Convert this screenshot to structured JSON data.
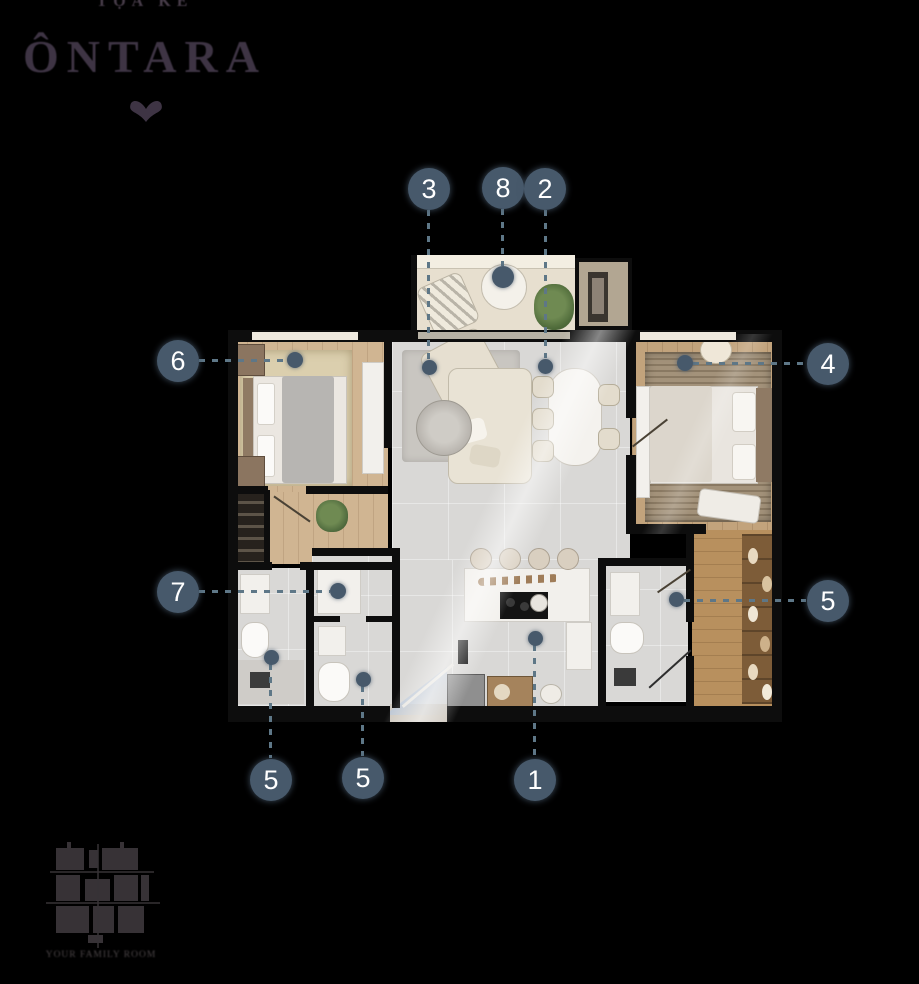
{
  "brand": {
    "tagline": "TỌA KỀ",
    "name": "ÔNTARA",
    "ornament_icon": "fleuron-heart"
  },
  "markers": [
    {
      "label": "3"
    },
    {
      "label": "8"
    },
    {
      "label": "2"
    },
    {
      "label": "6"
    },
    {
      "label": "4"
    },
    {
      "label": "7"
    },
    {
      "label": "5"
    },
    {
      "label": "5"
    },
    {
      "label": "5"
    },
    {
      "label": "1"
    }
  ],
  "keyplan": {
    "caption": "YOUR FAMILY ROOM"
  },
  "palette": {
    "background": "#000000",
    "marker_bg": "#47596b",
    "marker_text": "#ffffff",
    "leader_dash": "#5e7787",
    "logo_text": "#3e3444",
    "balcony_floor": "#e7dfcf",
    "living_tile": "#d9d8d6",
    "bedroom_wood": "#d0b592",
    "master_wood": "#c2a37c",
    "corridor_wood": "#b8905e",
    "wall": "#0d0d0d",
    "entry_glass": "#b9c7da"
  }
}
